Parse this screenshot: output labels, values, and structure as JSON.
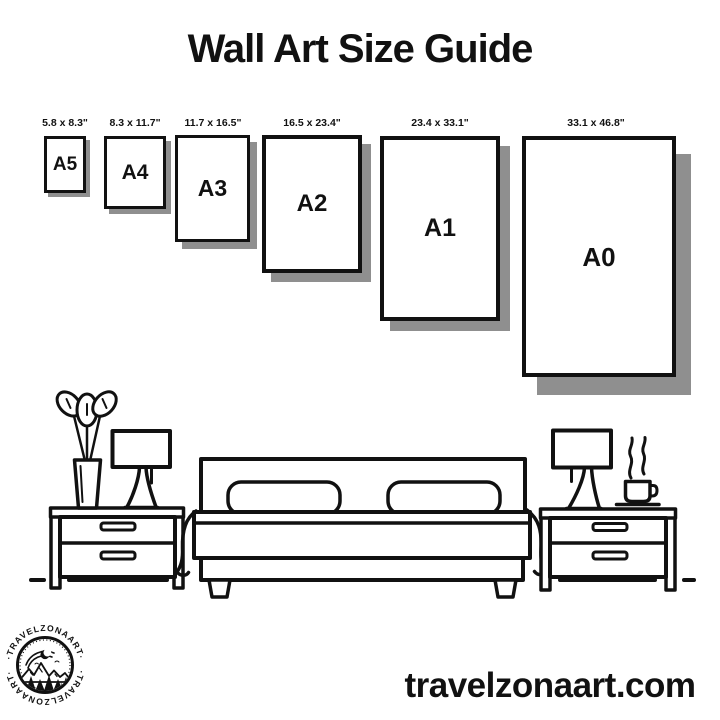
{
  "title": "Wall Art Size Guide",
  "frames": [
    {
      "label": "A5",
      "dimensions": "5.8 x 8.3\""
    },
    {
      "label": "A4",
      "dimensions": "8.3 x 11.7\""
    },
    {
      "label": "A3",
      "dimensions": "11.7 x 16.5\""
    },
    {
      "label": "A2",
      "dimensions": "16.5 x 23.4\""
    },
    {
      "label": "A1",
      "dimensions": "23.4 x 33.1\""
    },
    {
      "label": "A0",
      "dimensions": "33.1 x 46.8\""
    }
  ],
  "logo": {
    "ring_text_top": "·TRAVELZONAART·",
    "ring_text_bottom": "·TRAVELZONAART·"
  },
  "website": "travelzonaart.com",
  "colors": {
    "ink": "#111111",
    "shadow": "#8f8f8f",
    "background": "#ffffff"
  }
}
